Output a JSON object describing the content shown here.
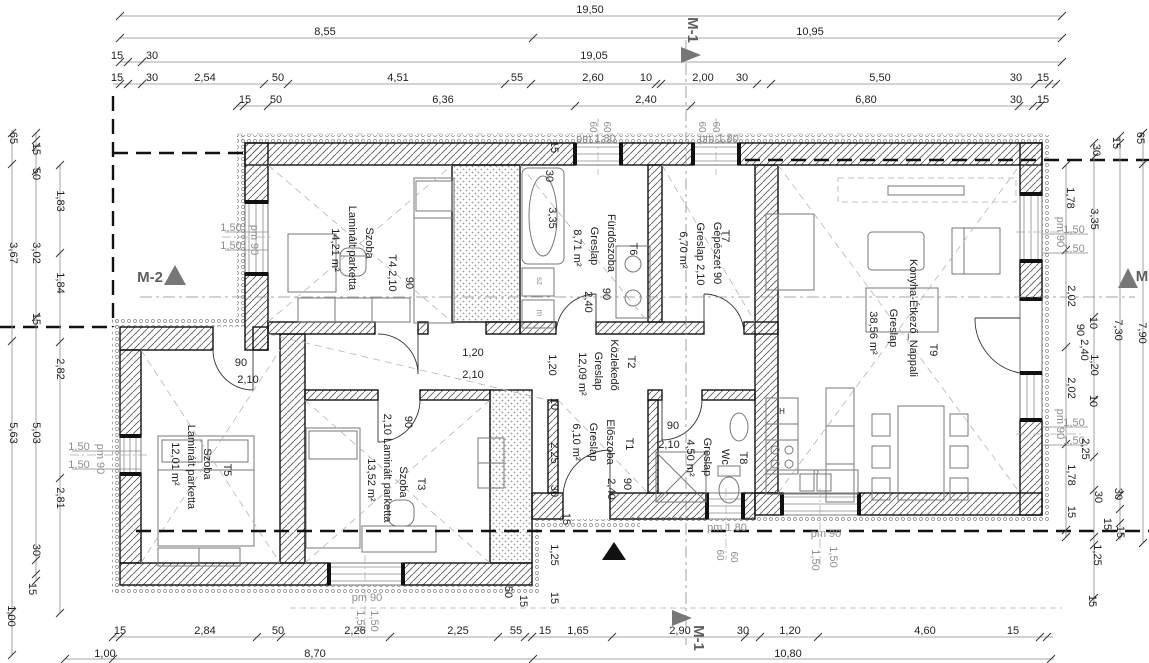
{
  "drawing": {
    "type": "floor-plan",
    "overall_width_label": "19,50",
    "overall_length_label": "19,05",
    "section_markers": [
      "M-1",
      "M-2",
      "M"
    ]
  },
  "rooms": [
    {
      "tag": "T1",
      "name": "Előszoba",
      "floor": "Greslap",
      "area": "6,10 m²"
    },
    {
      "tag": "T2",
      "name": "Közlekedő",
      "floor": "Greslap",
      "area": "12,09 m²"
    },
    {
      "tag": "T3",
      "name": "Szoba",
      "floor": "Laminált parketta",
      "area": "13,52 m²"
    },
    {
      "tag": "T4",
      "name": "Szoba",
      "floor": "Laminált parketta",
      "area": "14,21 m²"
    },
    {
      "tag": "T5",
      "name": "Szoba",
      "floor": "Laminált parketta",
      "area": "12,01 m²"
    },
    {
      "tag": "T6",
      "name": "Fürdőszoba",
      "floor": "Greslap",
      "area": "8,71 m²"
    },
    {
      "tag": "T7",
      "name": "Gépészet",
      "floor": "Greslap",
      "area": "6,70 m²"
    },
    {
      "tag": "T8",
      "name": "Wc",
      "floor": "Greslap",
      "area": "4,50 m²"
    },
    {
      "tag": "T9",
      "name": "Konyha-Étkező_Nappali",
      "floor": "Greslap",
      "area": "38,56 m²"
    }
  ],
  "labels": [
    {
      "t": "19,50",
      "x": 590,
      "y": 13
    },
    {
      "t": "8,55",
      "x": 325,
      "y": 35
    },
    {
      "t": "10,95",
      "x": 810,
      "y": 35
    },
    {
      "t": "15",
      "x": 117,
      "y": 59
    },
    {
      "t": "30",
      "x": 152,
      "y": 59
    },
    {
      "t": "19,05",
      "x": 594,
      "y": 59
    },
    {
      "t": "15",
      "x": 117,
      "y": 81
    },
    {
      "t": "30",
      "x": 152,
      "y": 81
    },
    {
      "t": "2,54",
      "x": 205,
      "y": 81
    },
    {
      "t": "50",
      "x": 278,
      "y": 81
    },
    {
      "t": "4,51",
      "x": 398,
      "y": 81
    },
    {
      "t": "55",
      "x": 517,
      "y": 81
    },
    {
      "t": "2,60",
      "x": 593,
      "y": 81
    },
    {
      "t": "10",
      "x": 646,
      "y": 81
    },
    {
      "t": "2,00",
      "x": 703,
      "y": 81
    },
    {
      "t": "30",
      "x": 742,
      "y": 81
    },
    {
      "t": "5,50",
      "x": 880,
      "y": 81
    },
    {
      "t": "30",
      "x": 1016,
      "y": 81
    },
    {
      "t": "15",
      "x": 1043,
      "y": 81
    },
    {
      "t": "15",
      "x": 245,
      "y": 103
    },
    {
      "t": "50",
      "x": 276,
      "y": 103
    },
    {
      "t": "6,36",
      "x": 443,
      "y": 103
    },
    {
      "t": "2,40",
      "x": 646,
      "y": 103
    },
    {
      "t": "6,80",
      "x": 866,
      "y": 103
    },
    {
      "t": "30",
      "x": 1016,
      "y": 103
    },
    {
      "t": "15",
      "x": 1043,
      "y": 103
    },
    {
      "t": "pm 1,80",
      "x": 596,
      "y": 142,
      "c": "g"
    },
    {
      "t": "pm 1,80",
      "x": 719,
      "y": 142,
      "c": "g"
    },
    {
      "t": "60",
      "x": 590,
      "y": 127,
      "o": "v",
      "c": "g",
      "s": 10
    },
    {
      "t": "60",
      "x": 604,
      "y": 127,
      "o": "v",
      "c": "g",
      "s": 10
    },
    {
      "t": "60",
      "x": 699,
      "y": 127,
      "o": "v",
      "c": "g",
      "s": 10
    },
    {
      "t": "60",
      "x": 713,
      "y": 127,
      "o": "v",
      "c": "g",
      "s": 10
    },
    {
      "t": "15",
      "x": 551,
      "y": 147,
      "o": "v"
    },
    {
      "t": "M-1",
      "x": 688,
      "y": 30,
      "o": "v",
      "c": "d",
      "s": 15,
      "n": "section-marker-m1-top"
    },
    {
      "t": "65",
      "x": 10,
      "y": 138,
      "o": "v"
    },
    {
      "t": "15",
      "x": 33,
      "y": 149,
      "o": "v"
    },
    {
      "t": "50",
      "x": 33,
      "y": 174,
      "o": "v"
    },
    {
      "t": "1,83",
      "x": 57,
      "y": 201,
      "o": "v"
    },
    {
      "t": "3,67",
      "x": 10,
      "y": 253,
      "o": "v"
    },
    {
      "t": "3,02",
      "x": 33,
      "y": 253,
      "o": "v"
    },
    {
      "t": "1,84",
      "x": 57,
      "y": 283,
      "o": "v"
    },
    {
      "t": "15",
      "x": 33,
      "y": 319,
      "o": "v"
    },
    {
      "t": "2,82",
      "x": 57,
      "y": 369,
      "o": "v"
    },
    {
      "t": "5,63",
      "x": 10,
      "y": 433,
      "o": "v"
    },
    {
      "t": "5,03",
      "x": 33,
      "y": 433,
      "o": "v"
    },
    {
      "t": "2,81",
      "x": 57,
      "y": 498,
      "o": "v"
    },
    {
      "t": "30",
      "x": 33,
      "y": 550,
      "o": "v"
    },
    {
      "t": "15",
      "x": 29,
      "y": 589,
      "o": "v"
    },
    {
      "t": "1,00",
      "x": 8,
      "y": 616,
      "o": "v"
    },
    {
      "t": "1,50",
      "x": 231,
      "y": 231,
      "c": "g"
    },
    {
      "t": "1,50",
      "x": 231,
      "y": 249,
      "c": "g"
    },
    {
      "t": "pm 90",
      "x": 251,
      "y": 240,
      "o": "v",
      "c": "g"
    },
    {
      "t": "1,50",
      "x": 79,
      "y": 450,
      "c": "g"
    },
    {
      "t": "1,50",
      "x": 79,
      "y": 468,
      "c": "g"
    },
    {
      "t": "pm 90",
      "x": 97,
      "y": 459,
      "o": "v",
      "c": "g"
    },
    {
      "t": "M-2",
      "x": 150,
      "y": 282,
      "c": "d",
      "s": 15,
      "n": "section-marker-m2"
    },
    {
      "t": "30",
      "x": 1093,
      "y": 150,
      "o": "v"
    },
    {
      "t": "15",
      "x": 1113,
      "y": 143,
      "o": "v"
    },
    {
      "t": "65",
      "x": 1137,
      "y": 138,
      "o": "v"
    },
    {
      "t": "1,78",
      "x": 1067,
      "y": 198,
      "o": "v"
    },
    {
      "t": "3,35",
      "x": 1091,
      "y": 219,
      "o": "v"
    },
    {
      "t": "pm 90",
      "x": 1057,
      "y": 232,
      "o": "v",
      "c": "g"
    },
    {
      "t": "1,50",
      "x": 1074,
      "y": 233,
      "c": "g"
    },
    {
      "t": "1,50",
      "x": 1074,
      "y": 252,
      "c": "g"
    },
    {
      "t": "2,02",
      "x": 1068,
      "y": 296,
      "o": "v"
    },
    {
      "t": "M",
      "x": 1142,
      "y": 281,
      "c": "d",
      "s": 15,
      "n": "section-marker-m-right"
    },
    {
      "t": "90",
      "x": 1077,
      "y": 330,
      "o": "v"
    },
    {
      "t": "10",
      "x": 1090,
      "y": 323,
      "o": "v"
    },
    {
      "t": "7,30",
      "x": 1115,
      "y": 330,
      "o": "v"
    },
    {
      "t": "7,90",
      "x": 1139,
      "y": 333,
      "o": "v"
    },
    {
      "t": "2,40",
      "x": 1081,
      "y": 350,
      "o": "v"
    },
    {
      "t": "1,20",
      "x": 1091,
      "y": 365,
      "o": "v"
    },
    {
      "t": "2,02",
      "x": 1068,
      "y": 388,
      "o": "v"
    },
    {
      "t": "10",
      "x": 1090,
      "y": 401,
      "o": "v"
    },
    {
      "t": "pm 90",
      "x": 1057,
      "y": 424,
      "o": "v",
      "c": "g"
    },
    {
      "t": "1,50",
      "x": 1074,
      "y": 426,
      "c": "g"
    },
    {
      "t": "1,50",
      "x": 1074,
      "y": 444,
      "c": "g"
    },
    {
      "t": "2,25",
      "x": 1082,
      "y": 449,
      "o": "v"
    },
    {
      "t": "1,78",
      "x": 1068,
      "y": 475,
      "o": "v"
    },
    {
      "t": "30",
      "x": 1095,
      "y": 497,
      "o": "v"
    },
    {
      "t": "30",
      "x": 1115,
      "y": 494,
      "o": "v"
    },
    {
      "t": "15",
      "x": 1068,
      "y": 512,
      "o": "v"
    },
    {
      "t": "15",
      "x": 1104,
      "y": 524,
      "o": "v"
    },
    {
      "t": "15",
      "x": 1117,
      "y": 532,
      "o": "v"
    },
    {
      "t": "1,25",
      "x": 1094,
      "y": 555,
      "o": "v"
    },
    {
      "t": "15",
      "x": 1089,
      "y": 601,
      "o": "v"
    },
    {
      "t": "15",
      "x": 120,
      "y": 634
    },
    {
      "t": "2,84",
      "x": 205,
      "y": 634
    },
    {
      "t": "50",
      "x": 278,
      "y": 634
    },
    {
      "t": "2,26",
      "x": 355,
      "y": 634
    },
    {
      "t": "2,25",
      "x": 458,
      "y": 634
    },
    {
      "t": "55",
      "x": 516,
      "y": 634
    },
    {
      "t": "15",
      "x": 545,
      "y": 634
    },
    {
      "t": "1,65",
      "x": 578,
      "y": 634
    },
    {
      "t": "2,90",
      "x": 680,
      "y": 634
    },
    {
      "t": "30",
      "x": 743,
      "y": 634
    },
    {
      "t": "1,20",
      "x": 790,
      "y": 634
    },
    {
      "t": "4,60",
      "x": 925,
      "y": 634
    },
    {
      "t": "15",
      "x": 1013,
      "y": 634
    },
    {
      "t": "1,00",
      "x": 105,
      "y": 657
    },
    {
      "t": "8,70",
      "x": 315,
      "y": 657
    },
    {
      "t": "10,80",
      "x": 788,
      "y": 657
    },
    {
      "t": "pm 90",
      "x": 367,
      "y": 601,
      "c": "g"
    },
    {
      "t": "1,50",
      "x": 357,
      "y": 621,
      "o": "v",
      "c": "g"
    },
    {
      "t": "1,50",
      "x": 371,
      "y": 621,
      "o": "v",
      "c": "g"
    },
    {
      "t": "pm 1,80",
      "x": 727,
      "y": 531,
      "c": "g"
    },
    {
      "t": "60",
      "x": 717,
      "y": 555,
      "o": "v",
      "c": "g",
      "s": 10
    },
    {
      "t": "60",
      "x": 731,
      "y": 557,
      "o": "v",
      "c": "g",
      "s": 10
    },
    {
      "t": "pm 90",
      "x": 826,
      "y": 537,
      "c": "g"
    },
    {
      "t": "1,50",
      "x": 812,
      "y": 560,
      "o": "v",
      "c": "g"
    },
    {
      "t": "1,50",
      "x": 830,
      "y": 557,
      "o": "v",
      "c": "g"
    },
    {
      "t": "M-1",
      "x": 694,
      "y": 638,
      "o": "v",
      "c": "d",
      "s": 15,
      "n": "section-marker-m1-bottom"
    },
    {
      "t": "50",
      "x": 505,
      "y": 592,
      "o": "v"
    },
    {
      "t": "15",
      "x": 520,
      "y": 601,
      "o": "v"
    },
    {
      "t": "30",
      "x": 551,
      "y": 491,
      "o": "v"
    },
    {
      "t": "1,25",
      "x": 551,
      "y": 555,
      "o": "v"
    },
    {
      "t": "15",
      "x": 563,
      "y": 519,
      "o": "v"
    },
    {
      "t": "15",
      "x": 551,
      "y": 598,
      "o": "v"
    },
    {
      "t": "Szoba",
      "x": 366,
      "y": 243,
      "o": "v",
      "n": "room-label-t4"
    },
    {
      "t": "Laminált parketta",
      "x": 349,
      "y": 248,
      "o": "v",
      "n": "room-floor-t4"
    },
    {
      "t": "14,21 m²",
      "x": 332,
      "y": 250,
      "o": "v",
      "n": "room-area-t4"
    },
    {
      "t": "T4  2,10",
      "x": 389,
      "y": 273,
      "o": "v",
      "n": "room-tag-t4"
    },
    {
      "t": "90",
      "x": 406,
      "y": 283,
      "o": "v"
    },
    {
      "t": "90",
      "x": 241,
      "y": 366
    },
    {
      "t": "2,10",
      "x": 248,
      "y": 383
    },
    {
      "t": "1,20",
      "x": 473,
      "y": 356
    },
    {
      "t": "2,10",
      "x": 473,
      "y": 378
    },
    {
      "t": "1,20",
      "x": 549,
      "y": 365,
      "o": "v"
    },
    {
      "t": "10",
      "x": 551,
      "y": 404,
      "o": "v"
    },
    {
      "t": "2,25",
      "x": 551,
      "y": 453,
      "o": "v"
    },
    {
      "t": "30",
      "x": 546,
      "y": 176,
      "o": "v"
    },
    {
      "t": "3,35",
      "x": 549,
      "y": 218,
      "o": "v"
    },
    {
      "t": "8,71 m²",
      "x": 574,
      "y": 248,
      "o": "v",
      "n": "room-area-t6"
    },
    {
      "t": "Greslap",
      "x": 591,
      "y": 246,
      "o": "v",
      "n": "room-floor-t6"
    },
    {
      "t": "Fürdőszoba",
      "x": 608,
      "y": 243,
      "o": "v",
      "n": "room-label-t6"
    },
    {
      "t": "2,40",
      "x": 585,
      "y": 302,
      "o": "v"
    },
    {
      "t": "90",
      "x": 603,
      "y": 294,
      "o": "v"
    },
    {
      "t": "T6",
      "x": 630,
      "y": 249,
      "o": "v",
      "n": "room-tag-t6"
    },
    {
      "t": "sz",
      "x": 537,
      "y": 281,
      "o": "v",
      "c": "g",
      "s": 8
    },
    {
      "t": "m",
      "x": 537,
      "y": 313,
      "o": "v",
      "c": "g",
      "s": 8
    },
    {
      "t": "6,70 m²",
      "x": 680,
      "y": 250,
      "o": "v",
      "n": "room-area-t7"
    },
    {
      "t": "Greslap  2,10",
      "x": 697,
      "y": 254,
      "o": "v",
      "n": "room-floor-t7"
    },
    {
      "t": "Gépészet  90",
      "x": 714,
      "y": 253,
      "o": "v",
      "n": "room-label-t7"
    },
    {
      "t": "T7",
      "x": 722,
      "y": 236,
      "o": "v",
      "n": "room-tag-t7"
    },
    {
      "t": "12,09 m²",
      "x": 579,
      "y": 374,
      "o": "v",
      "n": "room-area-t2"
    },
    {
      "t": "Greslap",
      "x": 595,
      "y": 371,
      "o": "v",
      "n": "room-floor-t2"
    },
    {
      "t": "Közlekedő",
      "x": 611,
      "y": 365,
      "o": "v",
      "n": "room-label-t2"
    },
    {
      "t": "T2",
      "x": 628,
      "y": 362,
      "o": "v",
      "n": "room-tag-t2"
    },
    {
      "t": "6,10 m²",
      "x": 573,
      "y": 442,
      "o": "v",
      "n": "room-area-t1"
    },
    {
      "t": "Greslap",
      "x": 590,
      "y": 442,
      "o": "v",
      "n": "room-floor-t1"
    },
    {
      "t": "Előszoba",
      "x": 607,
      "y": 442,
      "o": "v",
      "n": "room-label-t1"
    },
    {
      "t": "T1",
      "x": 626,
      "y": 444,
      "o": "v",
      "n": "room-tag-t1"
    },
    {
      "t": "90",
      "x": 624,
      "y": 484,
      "o": "v"
    },
    {
      "t": "2,40",
      "x": 608,
      "y": 489,
      "o": "v"
    },
    {
      "t": "90",
      "x": 673,
      "y": 429
    },
    {
      "t": "2,10",
      "x": 669,
      "y": 448
    },
    {
      "t": "4,50 m²",
      "x": 687,
      "y": 458,
      "o": "v",
      "n": "room-area-t8"
    },
    {
      "t": "Greslap",
      "x": 704,
      "y": 457,
      "o": "v",
      "n": "room-floor-t8"
    },
    {
      "t": "Wc",
      "x": 722,
      "y": 457,
      "o": "v",
      "n": "room-label-t8"
    },
    {
      "t": "T8",
      "x": 740,
      "y": 458,
      "o": "v",
      "n": "room-tag-t8"
    },
    {
      "t": "38,56 m²",
      "x": 870,
      "y": 333,
      "o": "v",
      "n": "room-area-t9"
    },
    {
      "t": "Greslap",
      "x": 890,
      "y": 328,
      "o": "v",
      "n": "room-floor-t9"
    },
    {
      "t": "Konyha-Étkező_Nappali",
      "x": 910,
      "y": 318,
      "o": "v",
      "n": "room-label-t9"
    },
    {
      "t": "T9",
      "x": 930,
      "y": 350,
      "o": "v",
      "n": "room-tag-t9"
    },
    {
      "t": "12,01 m²",
      "x": 172,
      "y": 464,
      "o": "v",
      "n": "room-area-t5"
    },
    {
      "t": "Laminált parketta",
      "x": 188,
      "y": 467,
      "o": "v",
      "n": "room-floor-t5"
    },
    {
      "t": "Szoba",
      "x": 204,
      "y": 464,
      "o": "v",
      "n": "room-label-t5"
    },
    {
      "t": "T5",
      "x": 224,
      "y": 470,
      "o": "v",
      "n": "room-tag-t5"
    },
    {
      "t": "13,52 m²",
      "x": 368,
      "y": 480,
      "o": "v",
      "n": "room-area-t3"
    },
    {
      "t": "2,10 Laminált parketta",
      "x": 384,
      "y": 468,
      "o": "v",
      "n": "room-floor-t3"
    },
    {
      "t": "Szoba",
      "x": 400,
      "y": 482,
      "o": "v",
      "n": "room-label-t3"
    },
    {
      "t": "90",
      "x": 405,
      "y": 422,
      "o": "v"
    },
    {
      "t": "T3",
      "x": 418,
      "y": 484,
      "o": "v",
      "n": "room-tag-t3"
    },
    {
      "t": "H",
      "x": 782,
      "y": 414,
      "s": 8
    }
  ]
}
